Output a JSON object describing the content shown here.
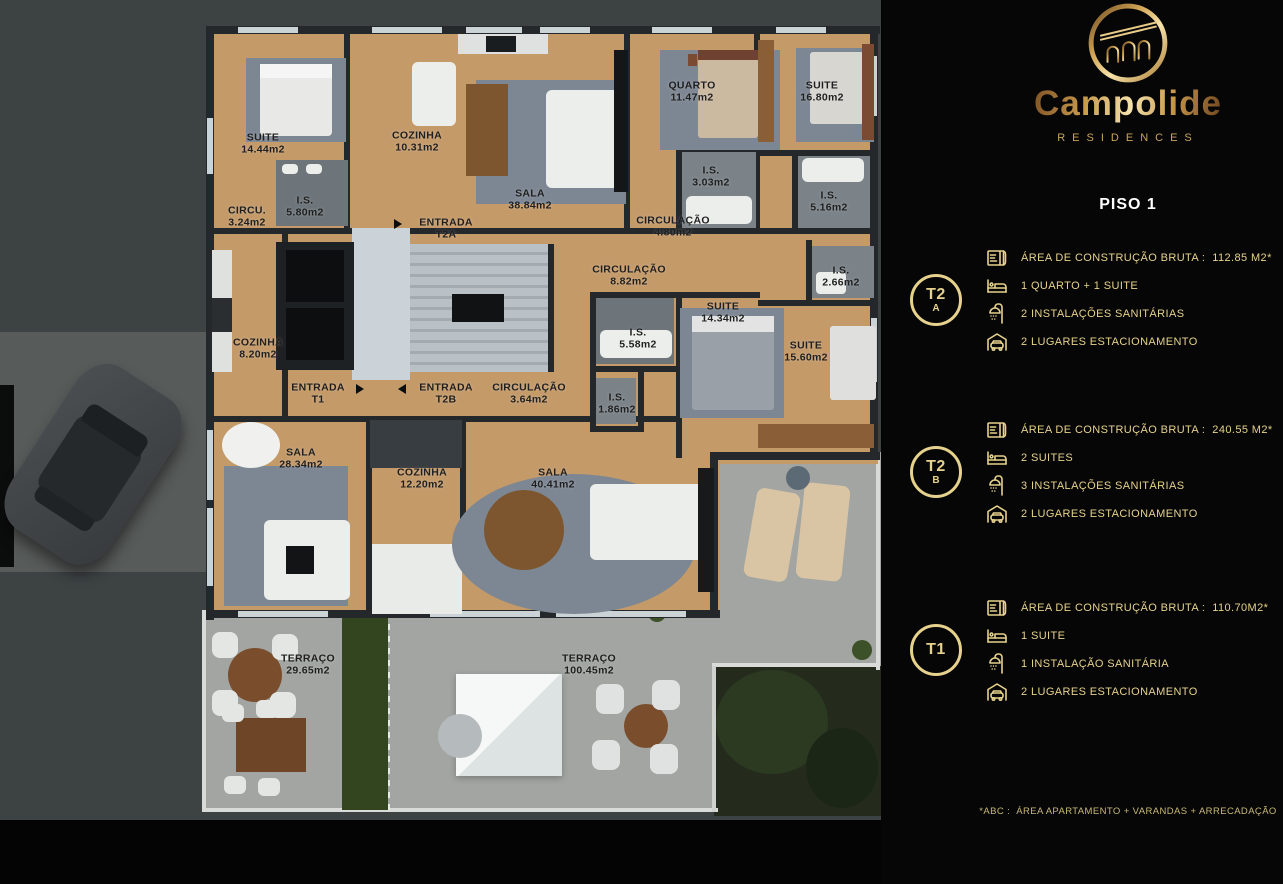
{
  "panel": {
    "brand": {
      "name": "Campolide",
      "sub": "RESIDENCES"
    },
    "floor_title": "PISO 1",
    "units": [
      {
        "badge_top": "T2",
        "badge_bottom": "A",
        "specs": [
          {
            "icon": "plan-icon",
            "text": "ÁREA DE CONSTRUÇÃO BRUTA :  112.85 M2*"
          },
          {
            "icon": "bed-icon",
            "text": "1 QUARTO + 1 SUITE"
          },
          {
            "icon": "shower-icon",
            "text": "2 INSTALAÇÕES SANITÁRIAS"
          },
          {
            "icon": "car-icon",
            "text": "2 LUGARES ESTACIONAMENTO"
          }
        ]
      },
      {
        "badge_top": "T2",
        "badge_bottom": "B",
        "specs": [
          {
            "icon": "plan-icon",
            "text": "ÁREA DE CONSTRUÇÃO BRUTA :  240.55 M2*"
          },
          {
            "icon": "bed-icon",
            "text": "2 SUITES"
          },
          {
            "icon": "shower-icon",
            "text": "3 INSTALAÇÕES SANITÁRIAS"
          },
          {
            "icon": "car-icon",
            "text": "2 LUGARES ESTACIONAMENTO"
          }
        ]
      },
      {
        "badge_top": "T1",
        "badge_bottom": "",
        "specs": [
          {
            "icon": "plan-icon",
            "text": "ÁREA DE CONSTRUÇÃO BRUTA :  110.70M2*"
          },
          {
            "icon": "bed-icon",
            "text": "1 SUITE"
          },
          {
            "icon": "shower-icon",
            "text": "1 INSTALAÇÃO SANITÁRIA"
          },
          {
            "icon": "car-icon",
            "text": "2 LUGARES ESTACIONAMENTO"
          }
        ]
      }
    ],
    "footnote": "*ABC :  ÁREA APARTAMENTO + VARANDAS + ARRECADAÇÃO",
    "colors": {
      "gold": "#c9a45c",
      "gold_text": "#e6d28c",
      "panel_bg": "#060606",
      "title": "#ffffff"
    }
  },
  "floorplan": {
    "label_color": "#1f1f1f",
    "labels": [
      {
        "l1": "SUITE",
        "l2": "14.44m2",
        "x": 263,
        "y": 144
      },
      {
        "l1": "COZINHA",
        "l2": "10.31m2",
        "x": 417,
        "y": 142
      },
      {
        "l1": "SALA",
        "l2": "38.84m2",
        "x": 530,
        "y": 200
      },
      {
        "l1": "QUARTO",
        "l2": "11.47m2",
        "x": 692,
        "y": 92
      },
      {
        "l1": "SUITE",
        "l2": "16.80m2",
        "x": 822,
        "y": 92
      },
      {
        "l1": "CIRCU.",
        "l2": "3.24m2",
        "x": 247,
        "y": 217
      },
      {
        "l1": "I.S.",
        "l2": "5.80m2",
        "x": 305,
        "y": 207
      },
      {
        "l1": "ENTRADA",
        "l2": "T2A",
        "x": 446,
        "y": 229
      },
      {
        "l1": "I.S.",
        "l2": "3.03m2",
        "x": 711,
        "y": 177
      },
      {
        "l1": "CIRCULAÇÃO",
        "l2": "4.80m2",
        "x": 673,
        "y": 227
      },
      {
        "l1": "I.S.",
        "l2": "5.16m2",
        "x": 829,
        "y": 202
      },
      {
        "l1": "CIRCULAÇÃO",
        "l2": "8.82m2",
        "x": 629,
        "y": 276
      },
      {
        "l1": "I.S.",
        "l2": "2.66m2",
        "x": 841,
        "y": 277
      },
      {
        "l1": "SUITE",
        "l2": "14.34m2",
        "x": 723,
        "y": 313
      },
      {
        "l1": "I.S.",
        "l2": "5.58m2",
        "x": 638,
        "y": 339
      },
      {
        "l1": "SUITE",
        "l2": "15.60m2",
        "x": 806,
        "y": 352
      },
      {
        "l1": "COZINHA",
        "l2": "8.20m2",
        "x": 258,
        "y": 349
      },
      {
        "l1": "ENTRADA",
        "l2": "T1",
        "x": 318,
        "y": 394
      },
      {
        "l1": "ENTRADA",
        "l2": "T2B",
        "x": 446,
        "y": 394
      },
      {
        "l1": "CIRCULAÇÃO",
        "l2": "3.64m2",
        "x": 529,
        "y": 394
      },
      {
        "l1": "I.S.",
        "l2": "1.86m2",
        "x": 617,
        "y": 404
      },
      {
        "l1": "SALA",
        "l2": "28.34m2",
        "x": 301,
        "y": 459
      },
      {
        "l1": "COZINHA",
        "l2": "12.20m2",
        "x": 422,
        "y": 479
      },
      {
        "l1": "SALA",
        "l2": "40.41m2",
        "x": 553,
        "y": 479
      },
      {
        "l1": "TERRAÇO",
        "l2": "29.65m2",
        "x": 308,
        "y": 665
      },
      {
        "l1": "TERRAÇO",
        "l2": "100.45m2",
        "x": 589,
        "y": 665
      }
    ]
  }
}
